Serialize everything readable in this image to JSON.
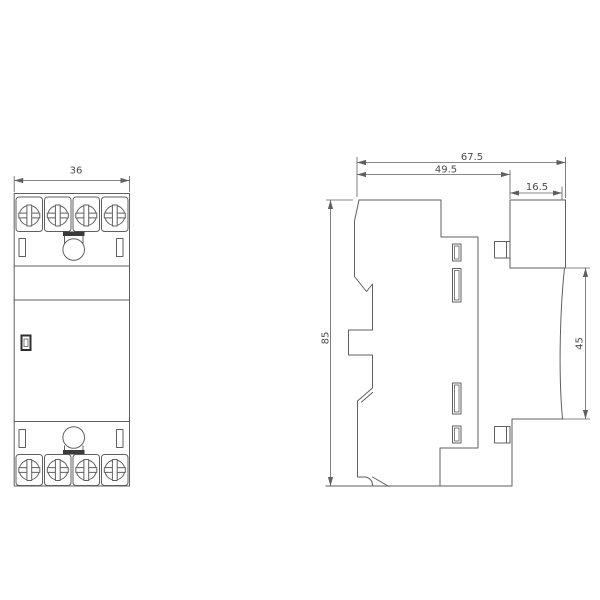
{
  "drawing": {
    "kind": "technical-dimension-drawing",
    "subject": "modular-din-rail-contactor",
    "front_view": {
      "width_dim_label": "36",
      "terminal_count_top": 4,
      "terminal_count_bottom": 4
    },
    "side_view": {
      "total_depth_dim_label": "67.5",
      "body_depth_dim_label": "49.5",
      "front_block_depth_dim_label": "16.5",
      "height_dim_label": "85",
      "panel_face_height_dim_label": "45"
    },
    "colors": {
      "line": "#5f5f5f",
      "dark": "#2e2e2e",
      "text": "#4a4a4a",
      "background": "#ffffff"
    }
  }
}
